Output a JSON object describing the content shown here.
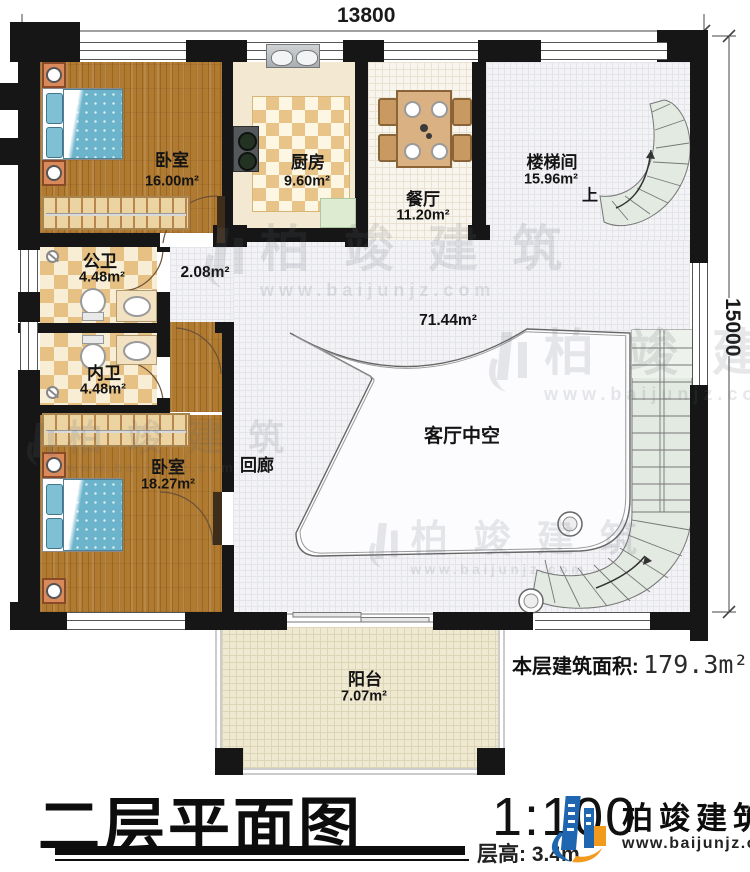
{
  "dimensions": {
    "top": "13800",
    "right": "15000"
  },
  "rooms": {
    "bedroom1": {
      "name": "卧室",
      "area": "16.00m²"
    },
    "kitchen": {
      "name": "厨房",
      "area": "9.60m²"
    },
    "dining": {
      "name": "餐厅",
      "area": "11.20m²"
    },
    "stairwell": {
      "name": "楼梯间",
      "area": "15.96m²",
      "up": "上"
    },
    "bath_public": {
      "name": "公卫",
      "area": "4.48m²"
    },
    "closet": {
      "area": "2.08m²"
    },
    "bath_private": {
      "name": "内卫",
      "area": "4.48m²"
    },
    "bedroom2": {
      "name": "卧室",
      "area": "18.27m²"
    },
    "corridor": {
      "name": "回廊"
    },
    "void": {
      "name": "客厅中空",
      "area": "71.44m²"
    },
    "balcony": {
      "name": "阳台",
      "area": "7.07m²"
    }
  },
  "area_note": {
    "label": "本层建筑面积:",
    "value": "179.3m²"
  },
  "footer": {
    "title": "二层平面图",
    "scale": "1:100",
    "height_label": "层高:",
    "height_value": "3.4m"
  },
  "branding": {
    "name": "柏竣建筑",
    "url": "www.baijunjz.com"
  },
  "watermark": {
    "name": "柏竣建筑",
    "url": "www.baijunjz.com"
  },
  "colors": {
    "wall": "#161616",
    "wood_floor": "#b07a31",
    "tile": "#e7c183",
    "stair": "#e3eae2",
    "bed": "#6cb4cc",
    "logo_blue": "#1f66b0",
    "logo_orange": "#f29a1e"
  }
}
